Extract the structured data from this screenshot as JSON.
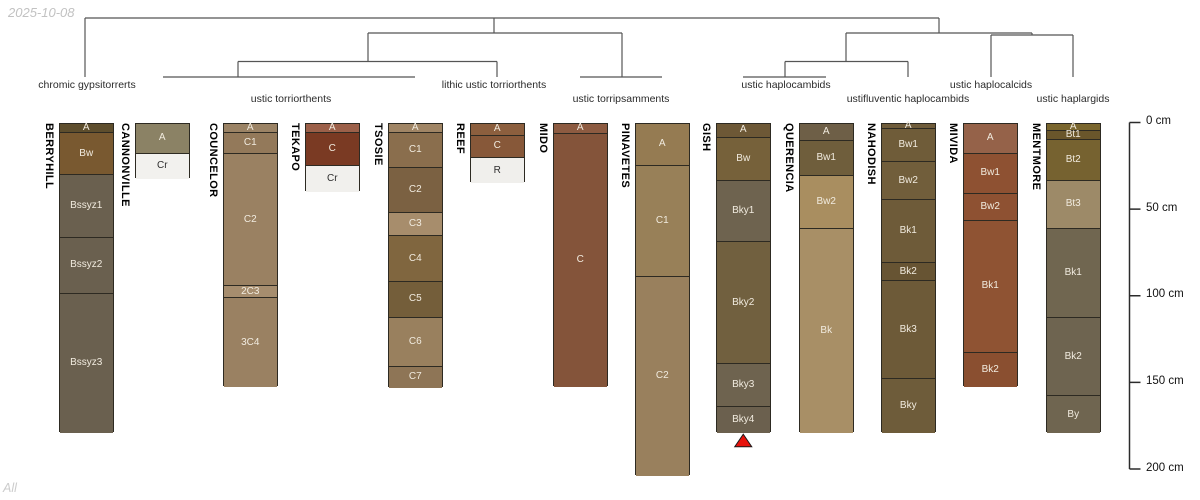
{
  "meta": {
    "date_label": "2025-10-08",
    "footer_label": "All"
  },
  "colors": {
    "dendrogram_line": "#555555",
    "axis_line": "#2b2b2b",
    "horizon_border": "#2d2a22",
    "horizon_text_light": "#f1ebdf",
    "horizon_text_dark": "#2e2e2e",
    "marker_red": "#e8130c"
  },
  "depth_axis": {
    "unit": "cm",
    "ticks": [
      {
        "cm": 0,
        "label": "0 cm"
      },
      {
        "cm": 50,
        "label": "50 cm"
      },
      {
        "cm": 100,
        "label": "100 cm"
      },
      {
        "cm": 150,
        "label": "150 cm"
      },
      {
        "cm": 200,
        "label": "200 cm"
      }
    ]
  },
  "chart_data": {
    "type": "dendrogram-soil-profiles",
    "title": "",
    "taxa_labels": [
      {
        "text": "chromic gypsitorrerts",
        "cx": 87,
        "row": 1
      },
      {
        "text": "ustic torriorthents",
        "cx": 291,
        "row": 2
      },
      {
        "text": "lithic ustic torriorthents",
        "cx": 494,
        "row": 1
      },
      {
        "text": "ustic torripsamments",
        "cx": 621,
        "row": 2
      },
      {
        "text": "ustic haplocambids",
        "cx": 786,
        "row": 1
      },
      {
        "text": "ustifluventic haplocambids",
        "cx": 908,
        "row": 2
      },
      {
        "text": "ustic haplocalcids",
        "cx": 991,
        "row": 1
      },
      {
        "text": "ustic haplargids",
        "cx": 1073,
        "row": 2
      }
    ],
    "dendrogram_segments": [
      [
        85,
        18,
        939,
        18
      ],
      [
        85,
        18,
        85,
        77
      ],
      [
        494,
        18,
        494,
        33
      ],
      [
        368,
        33,
        622,
        33
      ],
      [
        368,
        33,
        368,
        61.5
      ],
      [
        238,
        61.5,
        497,
        61.5
      ],
      [
        238,
        61.5,
        238,
        77
      ],
      [
        163,
        77,
        415,
        77
      ],
      [
        497,
        61.5,
        497,
        77
      ],
      [
        622,
        33,
        622,
        77
      ],
      [
        580,
        77,
        662,
        77
      ],
      [
        939,
        18,
        939,
        33
      ],
      [
        846,
        33,
        1032,
        33
      ],
      [
        846,
        33,
        846,
        61.5
      ],
      [
        785,
        61.5,
        908,
        61.5
      ],
      [
        785,
        61.5,
        785,
        77
      ],
      [
        743,
        77,
        826,
        77
      ],
      [
        908,
        61.5,
        908,
        77
      ],
      [
        1032,
        33,
        1032,
        35
      ],
      [
        991,
        35,
        1073,
        35
      ],
      [
        991,
        35,
        991,
        77
      ],
      [
        1073,
        35,
        1073,
        77
      ]
    ],
    "marker": {
      "profile": "GISH",
      "shape": "triangle-up",
      "color": "#e8130c"
    },
    "profiles": [
      {
        "name": "BERRYHILL",
        "x": 59,
        "horizons": [
          {
            "name": "A",
            "top_cm": 0,
            "bottom_cm": 5.5,
            "color": "#5e4e2d"
          },
          {
            "name": "Bw",
            "top_cm": 5.5,
            "bottom_cm": 30,
            "color": "#795930"
          },
          {
            "name": "Bssyz1",
            "top_cm": 30,
            "bottom_cm": 66,
            "color": "#6a604f"
          },
          {
            "name": "Bssyz2",
            "top_cm": 66,
            "bottom_cm": 98.5,
            "color": "#6a604f"
          },
          {
            "name": "Bssyz3",
            "top_cm": 98.5,
            "bottom_cm": 178.5,
            "color": "#6a604f"
          }
        ]
      },
      {
        "name": "CANNONVILLE",
        "x": 135,
        "horizons": [
          {
            "name": "A",
            "top_cm": 0,
            "bottom_cm": 17.5,
            "color": "#8b8265"
          },
          {
            "name": "Cr",
            "top_cm": 17.5,
            "bottom_cm": 32,
            "color": "#f2f1ee",
            "dark_text": true
          }
        ]
      },
      {
        "name": "COUNCELOR",
        "x": 223,
        "horizons": [
          {
            "name": "A",
            "top_cm": 0,
            "bottom_cm": 5.5,
            "color": "#9b8365"
          },
          {
            "name": "C1",
            "top_cm": 5.5,
            "bottom_cm": 17.5,
            "color": "#93795a"
          },
          {
            "name": "C2",
            "top_cm": 17.5,
            "bottom_cm": 94,
            "color": "#9a8162"
          },
          {
            "name": "2C3",
            "top_cm": 94,
            "bottom_cm": 101,
            "color": "#a68d6e"
          },
          {
            "name": "3C4",
            "top_cm": 101,
            "bottom_cm": 152,
            "color": "#9a8162"
          }
        ]
      },
      {
        "name": "TEKAPO",
        "x": 305,
        "horizons": [
          {
            "name": "A",
            "top_cm": 0,
            "bottom_cm": 5.5,
            "color": "#9c6049"
          },
          {
            "name": "C",
            "top_cm": 5.5,
            "bottom_cm": 24.5,
            "color": "#7a3a23"
          },
          {
            "name": "Cr",
            "top_cm": 24.5,
            "bottom_cm": 39.5,
            "color": "#f1f0ed",
            "dark_text": true
          }
        ]
      },
      {
        "name": "TSOSIE",
        "x": 388,
        "horizons": [
          {
            "name": "A",
            "top_cm": 0,
            "bottom_cm": 5.5,
            "color": "#a08565"
          },
          {
            "name": "C1",
            "top_cm": 5.5,
            "bottom_cm": 25.5,
            "color": "#8a6e4d"
          },
          {
            "name": "C2",
            "top_cm": 25.5,
            "bottom_cm": 51.5,
            "color": "#7b6142"
          },
          {
            "name": "C3",
            "top_cm": 51.5,
            "bottom_cm": 65,
            "color": "#a78d6c"
          },
          {
            "name": "C4",
            "top_cm": 65,
            "bottom_cm": 91.5,
            "color": "#80663f"
          },
          {
            "name": "C5",
            "top_cm": 91.5,
            "bottom_cm": 112,
            "color": "#745e3a"
          },
          {
            "name": "C6",
            "top_cm": 112,
            "bottom_cm": 140.5,
            "color": "#99805e"
          },
          {
            "name": "C7",
            "top_cm": 140.5,
            "bottom_cm": 152.5,
            "color": "#8e7556"
          }
        ]
      },
      {
        "name": "REEF",
        "x": 470,
        "horizons": [
          {
            "name": "A",
            "top_cm": 0,
            "bottom_cm": 7,
            "color": "#8c5f3e"
          },
          {
            "name": "C",
            "top_cm": 7,
            "bottom_cm": 20,
            "color": "#875839"
          },
          {
            "name": "R",
            "top_cm": 20,
            "bottom_cm": 34.5,
            "color": "#f0efec",
            "dark_text": true
          }
        ]
      },
      {
        "name": "MIDO",
        "x": 553,
        "horizons": [
          {
            "name": "A",
            "top_cm": 0,
            "bottom_cm": 6,
            "color": "#8d5b41"
          },
          {
            "name": "C",
            "top_cm": 6,
            "bottom_cm": 152,
            "color": "#84543a"
          }
        ]
      },
      {
        "name": "PINAVETES",
        "x": 635,
        "horizons": [
          {
            "name": "A",
            "top_cm": 0,
            "bottom_cm": 24.5,
            "color": "#957b52"
          },
          {
            "name": "C1",
            "top_cm": 24.5,
            "bottom_cm": 88.5,
            "color": "#988058"
          },
          {
            "name": "C2",
            "top_cm": 88.5,
            "bottom_cm": 203.5,
            "color": "#99805d"
          }
        ]
      },
      {
        "name": "GISH",
        "x": 716,
        "horizons": [
          {
            "name": "A",
            "top_cm": 0,
            "bottom_cm": 8.5,
            "color": "#6d5836"
          },
          {
            "name": "Bw",
            "top_cm": 8.5,
            "bottom_cm": 33,
            "color": "#76613a"
          },
          {
            "name": "Bky1",
            "top_cm": 33,
            "bottom_cm": 68.5,
            "color": "#6e634f"
          },
          {
            "name": "Bky2",
            "top_cm": 68.5,
            "bottom_cm": 139,
            "color": "#71603f"
          },
          {
            "name": "Bky3",
            "top_cm": 139,
            "bottom_cm": 163.5,
            "color": "#6e634f"
          },
          {
            "name": "Bky4",
            "top_cm": 163.5,
            "bottom_cm": 178.5,
            "color": "#6b604e"
          }
        ]
      },
      {
        "name": "QUERENCIA",
        "x": 799,
        "horizons": [
          {
            "name": "A",
            "top_cm": 0,
            "bottom_cm": 10,
            "color": "#6e5f47"
          },
          {
            "name": "Bw1",
            "top_cm": 10,
            "bottom_cm": 30.5,
            "color": "#6f5e3c"
          },
          {
            "name": "Bw2",
            "top_cm": 30.5,
            "bottom_cm": 61,
            "color": "#a98e60"
          },
          {
            "name": "Bk",
            "top_cm": 61,
            "bottom_cm": 178.5,
            "color": "#a88f66"
          }
        ]
      },
      {
        "name": "NAHODISH",
        "x": 881,
        "horizons": [
          {
            "name": "A",
            "top_cm": 0,
            "bottom_cm": 3,
            "color": "#6f5c3a"
          },
          {
            "name": "Bw1",
            "top_cm": 3,
            "bottom_cm": 22.5,
            "color": "#6f5c39"
          },
          {
            "name": "Bw2",
            "top_cm": 22.5,
            "bottom_cm": 44,
            "color": "#715e3b"
          },
          {
            "name": "Bk1",
            "top_cm": 44,
            "bottom_cm": 80.5,
            "color": "#6e5b39"
          },
          {
            "name": "Bk2",
            "top_cm": 80.5,
            "bottom_cm": 91,
            "color": "#675433"
          },
          {
            "name": "Bk3",
            "top_cm": 91,
            "bottom_cm": 147.5,
            "color": "#6d5a38"
          },
          {
            "name": "Bky",
            "top_cm": 147.5,
            "bottom_cm": 178.5,
            "color": "#6e5c3a"
          }
        ]
      },
      {
        "name": "MIVIDA",
        "x": 963,
        "horizons": [
          {
            "name": "A",
            "top_cm": 0,
            "bottom_cm": 17.5,
            "color": "#956249"
          },
          {
            "name": "Bw1",
            "top_cm": 17.5,
            "bottom_cm": 40.5,
            "color": "#8e5132"
          },
          {
            "name": "Bw2",
            "top_cm": 40.5,
            "bottom_cm": 56,
            "color": "#8e5132"
          },
          {
            "name": "Bk1",
            "top_cm": 56,
            "bottom_cm": 132.5,
            "color": "#8f5333"
          },
          {
            "name": "Bk2",
            "top_cm": 132.5,
            "bottom_cm": 152,
            "color": "#8a4f30"
          }
        ]
      },
      {
        "name": "MENTMORE",
        "x": 1046,
        "horizons": [
          {
            "name": "A",
            "top_cm": 0,
            "bottom_cm": 4.5,
            "color": "#7a662e"
          },
          {
            "name": "Bt1",
            "top_cm": 4.5,
            "bottom_cm": 9.5,
            "color": "#6a562b"
          },
          {
            "name": "Bt2",
            "top_cm": 9.5,
            "bottom_cm": 33,
            "color": "#766230"
          },
          {
            "name": "Bt3",
            "top_cm": 33,
            "bottom_cm": 61,
            "color": "#9d8a68"
          },
          {
            "name": "Bk1",
            "top_cm": 61,
            "bottom_cm": 112.5,
            "color": "#706650"
          },
          {
            "name": "Bk2",
            "top_cm": 112.5,
            "bottom_cm": 157.5,
            "color": "#6e6450"
          },
          {
            "name": "By",
            "top_cm": 157.5,
            "bottom_cm": 178.5,
            "color": "#6f6550"
          }
        ]
      }
    ]
  }
}
